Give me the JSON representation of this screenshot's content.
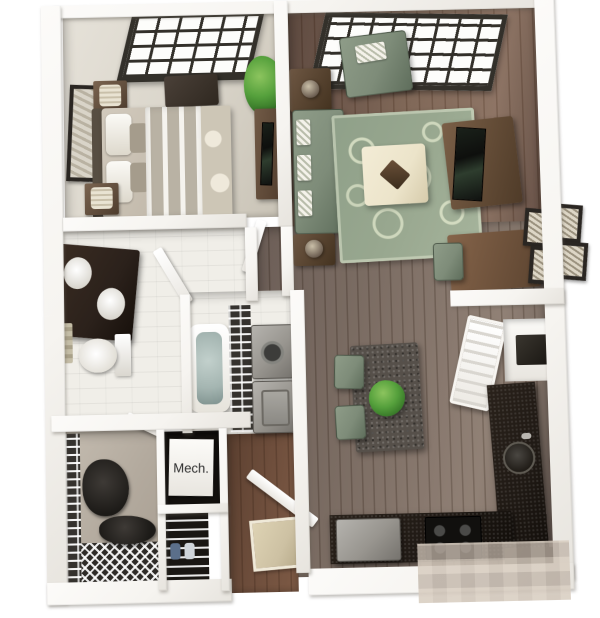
{
  "labels": {
    "mech_room": "Mech."
  },
  "palette": {
    "bg": "#ffffff",
    "wall": "#f6f4f0",
    "wall_shade": "#d9d6cf",
    "wood": "#7c6353",
    "wood_dark": "#59443a",
    "wood_gray": "#7b6b61",
    "wood_warm": "#6e4e3c",
    "carpet_bedroom": "#d8d3c8",
    "tile": "#f0eee8",
    "carpet_closet": "#b3aa9e",
    "sage": "#7e8c79",
    "sage_dark": "#5f6e5c",
    "rug": "#98a78f",
    "cream": "#ece4ca",
    "brown_wood": "#6b5340",
    "espresso": "#2b211b",
    "counter": "#1f1914",
    "appliance": "#98958f",
    "tub_water": "#a4b5b1",
    "plant": "#55a03c",
    "plant_dark": "#2e6b22",
    "window_frame": "#33302a",
    "granite": "#56504a",
    "dark_room": "#15120f",
    "door": "#fbfaf7",
    "doormat": "#cdc1a3"
  },
  "rooms": [
    {
      "name": "bedroom"
    },
    {
      "name": "living-room"
    },
    {
      "name": "bathroom"
    },
    {
      "name": "laundry-closet"
    },
    {
      "name": "walk-in-closet"
    },
    {
      "name": "mechanical-closet"
    },
    {
      "name": "entry-hall"
    },
    {
      "name": "dining-area"
    },
    {
      "name": "kitchen"
    }
  ]
}
